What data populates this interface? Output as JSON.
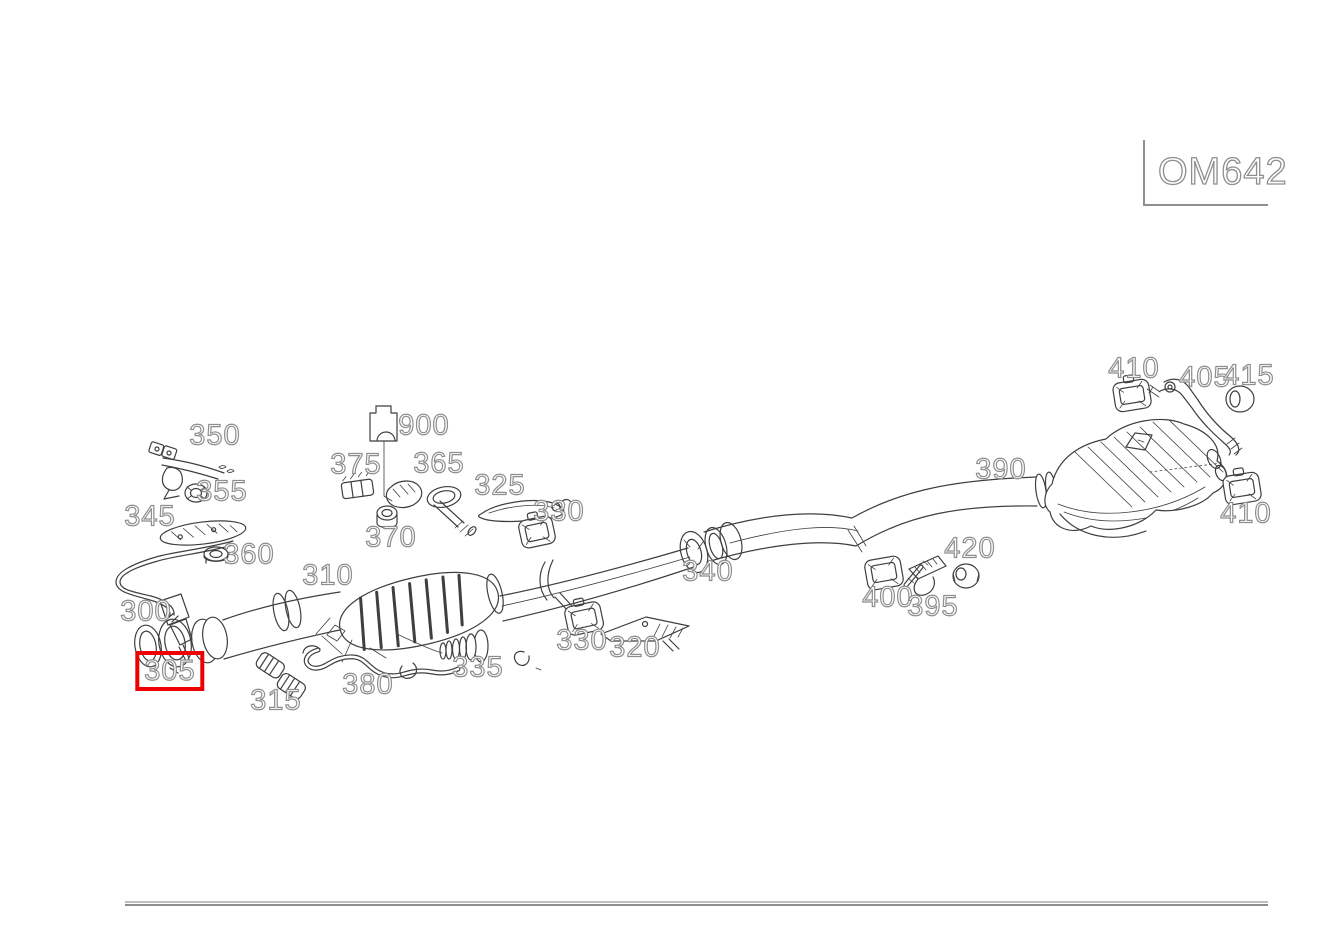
{
  "diagram": {
    "engine_code": "OM642",
    "selected_part": "305",
    "colors": {
      "highlight": "#ee0000",
      "line": "#3f3f3f",
      "label_outline": "#8e8e8e",
      "divider": "#9a9a9a"
    },
    "labels": [
      {
        "id": "350",
        "text": "350",
        "x": 215,
        "y": 436
      },
      {
        "id": "355",
        "text": "355",
        "x": 222,
        "y": 492
      },
      {
        "id": "345",
        "text": "345",
        "x": 150,
        "y": 517
      },
      {
        "id": "360",
        "text": "360",
        "x": 249,
        "y": 555
      },
      {
        "id": "300",
        "text": "300",
        "x": 146,
        "y": 612
      },
      {
        "id": "305",
        "text": "305",
        "x": 170,
        "y": 671,
        "highlighted": true
      },
      {
        "id": "315",
        "text": "315",
        "x": 276,
        "y": 701
      },
      {
        "id": "380",
        "text": "380",
        "x": 368,
        "y": 685
      },
      {
        "id": "310",
        "text": "310",
        "x": 328,
        "y": 576
      },
      {
        "id": "375",
        "text": "375",
        "x": 356,
        "y": 465
      },
      {
        "id": "370",
        "text": "370",
        "x": 391,
        "y": 538
      },
      {
        "id": "900",
        "text": "900",
        "x": 424,
        "y": 426
      },
      {
        "id": "365",
        "text": "365",
        "x": 439,
        "y": 464
      },
      {
        "id": "325",
        "text": "325",
        "x": 500,
        "y": 486
      },
      {
        "id": "330-upper",
        "text": "330",
        "x": 559,
        "y": 512
      },
      {
        "id": "330-lower",
        "text": "330",
        "x": 582,
        "y": 641
      },
      {
        "id": "320",
        "text": "320",
        "x": 635,
        "y": 648
      },
      {
        "id": "335",
        "text": "335",
        "x": 478,
        "y": 668
      },
      {
        "id": "340",
        "text": "340",
        "x": 708,
        "y": 572
      },
      {
        "id": "390",
        "text": "390",
        "x": 1001,
        "y": 470
      },
      {
        "id": "420",
        "text": "420",
        "x": 970,
        "y": 549
      },
      {
        "id": "400",
        "text": "400",
        "x": 888,
        "y": 598
      },
      {
        "id": "395",
        "text": "395",
        "x": 933,
        "y": 607
      },
      {
        "id": "410-front",
        "text": "410",
        "x": 1134,
        "y": 369
      },
      {
        "id": "405",
        "text": "405",
        "x": 1205,
        "y": 378
      },
      {
        "id": "415",
        "text": "415",
        "x": 1249,
        "y": 376
      },
      {
        "id": "410-rear",
        "text": "410",
        "x": 1246,
        "y": 514
      }
    ]
  }
}
